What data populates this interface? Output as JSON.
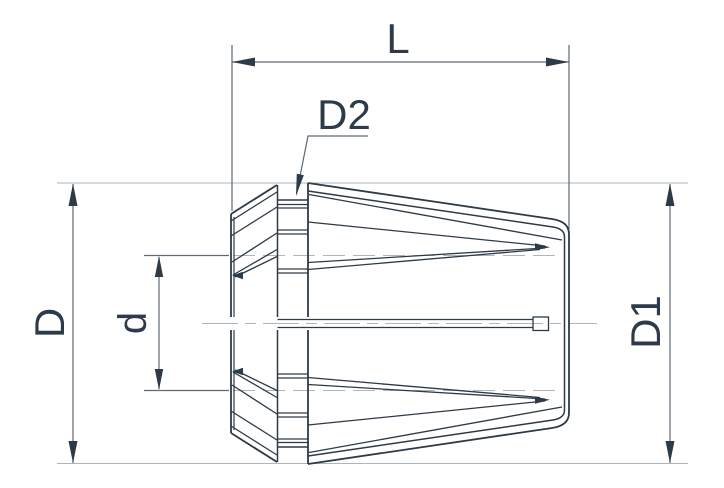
{
  "drawing": {
    "labels": {
      "length": "L",
      "neck_diameter": "D2",
      "outer_diameter": "D",
      "bore_diameter": "d",
      "rear_diameter": "D1"
    },
    "colors": {
      "ink": "#2d3a47",
      "dimension": "#5d6974",
      "reference": "#aeb5bc",
      "background": "#ffffff"
    }
  }
}
